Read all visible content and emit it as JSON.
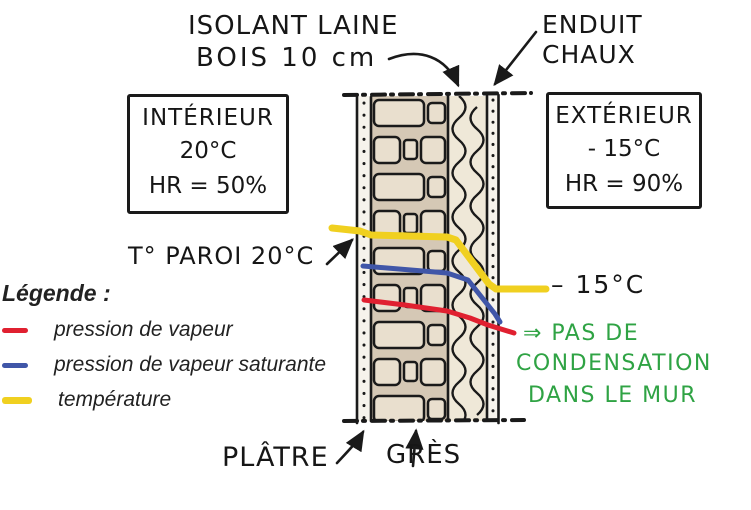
{
  "colors": {
    "ink": "#1a1a1a",
    "vapor_pressure_red": "#e02030",
    "saturation_blue": "#4056a8",
    "temperature_yellow": "#f0d020",
    "conclusion_green": "#2fa344",
    "stone_fill": "#e9dfce",
    "stone_bg": "#d5c8b5",
    "insulation_fill": "#efe8d8",
    "plaster_fill": "#f6f3ec"
  },
  "top_labels": {
    "insulation_line1": "ISOLANT LAINE",
    "insulation_line2": "BOIS 10 cm",
    "render_line1": "ENDUIT",
    "render_line2": "CHAUX"
  },
  "interior_box": {
    "title": "INTÉRIEUR",
    "temperature": "20°C",
    "humidity": "HR = 50%"
  },
  "exterior_box": {
    "title": "EXTÉRIEUR",
    "temperature": "- 15°C",
    "humidity": "HR = 90%"
  },
  "annotations": {
    "wall_surface_temp": "T° PAROI 20°C",
    "outside_surface_temp": "– 15°C",
    "conclusion_line1": "⇒ PAS DE",
    "conclusion_line2": "CONDENSATION",
    "conclusion_line3": "DANS LE MUR",
    "plaster_label": "PLÂTRE",
    "sandstone_label": "GRÈS"
  },
  "legend": {
    "title": "Légende :",
    "items": [
      {
        "label": "pression de vapeur",
        "color": "#e02030"
      },
      {
        "label": "pression de vapeur saturante",
        "color": "#4056a8"
      },
      {
        "label": "température",
        "color": "#f0d020"
      }
    ]
  }
}
